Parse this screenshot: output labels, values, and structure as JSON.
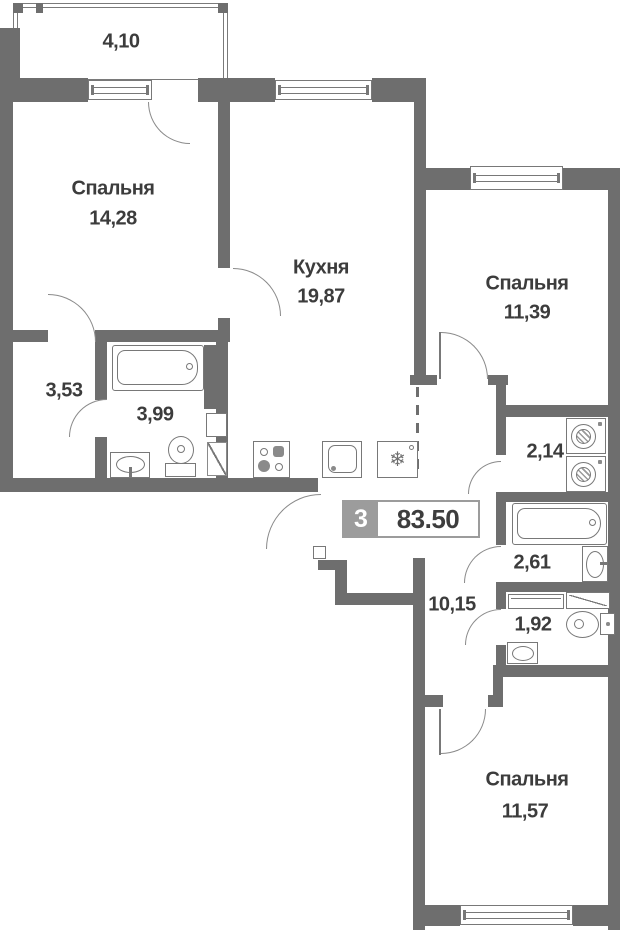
{
  "plan": {
    "badge": {
      "rooms_count": "3",
      "total_area": "83.50"
    },
    "balcony": {
      "area": "4,10"
    },
    "rooms": {
      "bedroom1": {
        "name": "Спальня",
        "area": "14,28"
      },
      "kitchen": {
        "name": "Кухня",
        "area": "19,87"
      },
      "bedroom2": {
        "name": "Спальня",
        "area": "11,39"
      },
      "hallway": {
        "area": "3,53"
      },
      "bathroom": {
        "area": "3,99"
      },
      "laundry": {
        "area": "2,14"
      },
      "bathroom2": {
        "area": "2,61"
      },
      "corridor": {
        "area": "10,15"
      },
      "wc": {
        "area": "1,92"
      },
      "bedroom3": {
        "name": "Спальня",
        "area": "11,57"
      }
    },
    "icons": {
      "snowflake": "❄"
    }
  }
}
